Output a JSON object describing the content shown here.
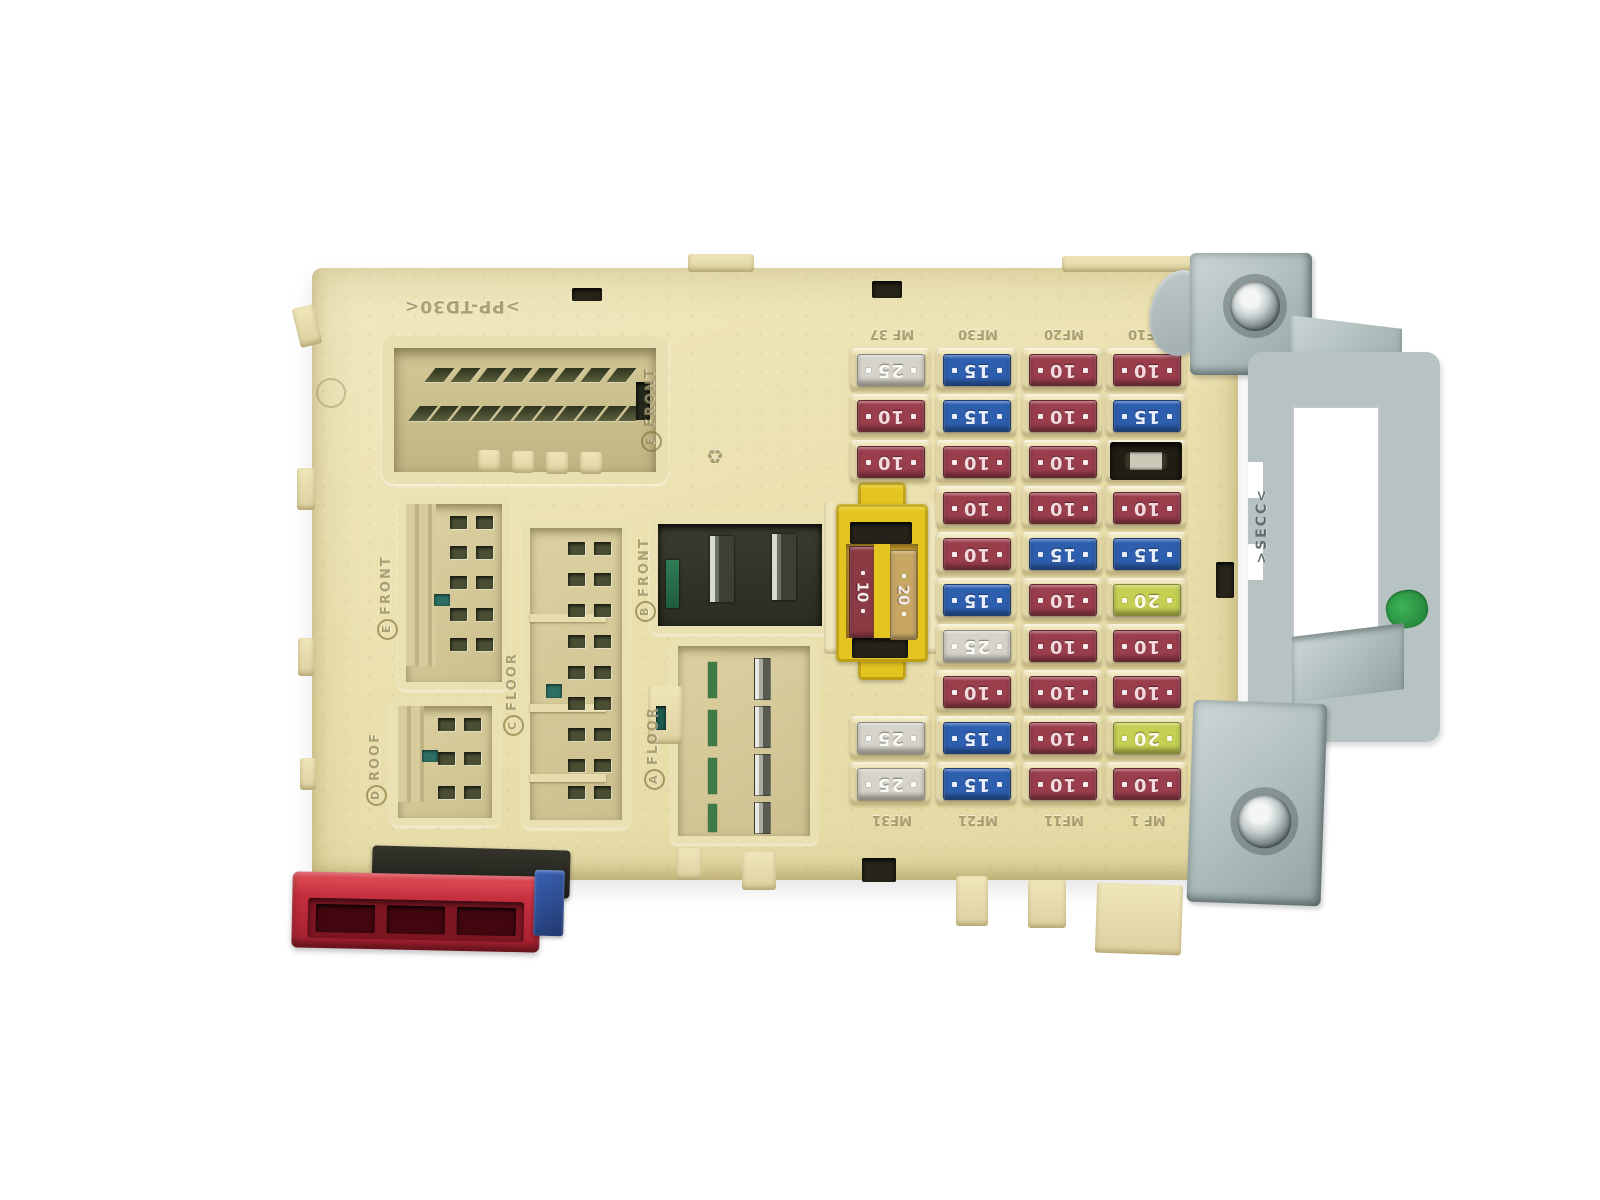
{
  "molded": {
    "part_number": ">PP-TD30<",
    "recycle_mark": "♻"
  },
  "connector_labels": [
    {
      "letter": "F",
      "word": "FRONT"
    },
    {
      "letter": "E",
      "word": "FRONT"
    },
    {
      "letter": "D",
      "word": "ROOF"
    },
    {
      "letter": "C",
      "word": "FLOOR"
    },
    {
      "letter": "B",
      "word": "FRONT"
    },
    {
      "letter": "A",
      "word": "FLOOR"
    }
  ],
  "relay": {
    "fuse_left": "10",
    "fuse_right": "20"
  },
  "fuse_panel": {
    "columns": [
      {
        "top_label": "MF 37",
        "bottom_label": "MF31",
        "fuses": [
          "25",
          "10",
          "10",
          null,
          null,
          null,
          null,
          null,
          "25",
          "25"
        ]
      },
      {
        "top_label": "MF30",
        "bottom_label": "MF21",
        "fuses": [
          "15",
          "15",
          "10",
          "10",
          "10",
          "15",
          "25",
          "10",
          "15",
          "15"
        ]
      },
      {
        "top_label": "MF20",
        "bottom_label": "MF11",
        "fuses": [
          "10",
          "10",
          "10",
          "10",
          "15",
          "10",
          "10",
          "10",
          "10",
          "10"
        ]
      },
      {
        "top_label": "MF10",
        "bottom_label": "MF 1",
        "fuses": [
          "10",
          "15",
          "EMPTY",
          "10",
          "15",
          "20",
          "10",
          "10",
          "20",
          "10"
        ]
      }
    ],
    "fuse_colors": {
      "10": "#9a3e4c",
      "15": "#2e5fae",
      "20": "#c5cf52",
      "25": "#d6d4ca"
    },
    "fuse_text_colors": {
      "10": "#f2dade",
      "15": "#e9effc",
      "20": "#fdfbe8",
      "25": "#fbfbf6"
    }
  },
  "bracket": {
    "stamp": ">SECC<"
  },
  "colors": {
    "body_cream": "#ebe1af",
    "holder_cream": "#f1e8bf",
    "relay_yellow": "#e4c41f",
    "relay_amber": "#b8922e",
    "metal_gray": "#b4c1c1",
    "red_connector": "#c5303f",
    "blue_connector": "#2c4f9e",
    "green_paint": "#2f9e46"
  }
}
